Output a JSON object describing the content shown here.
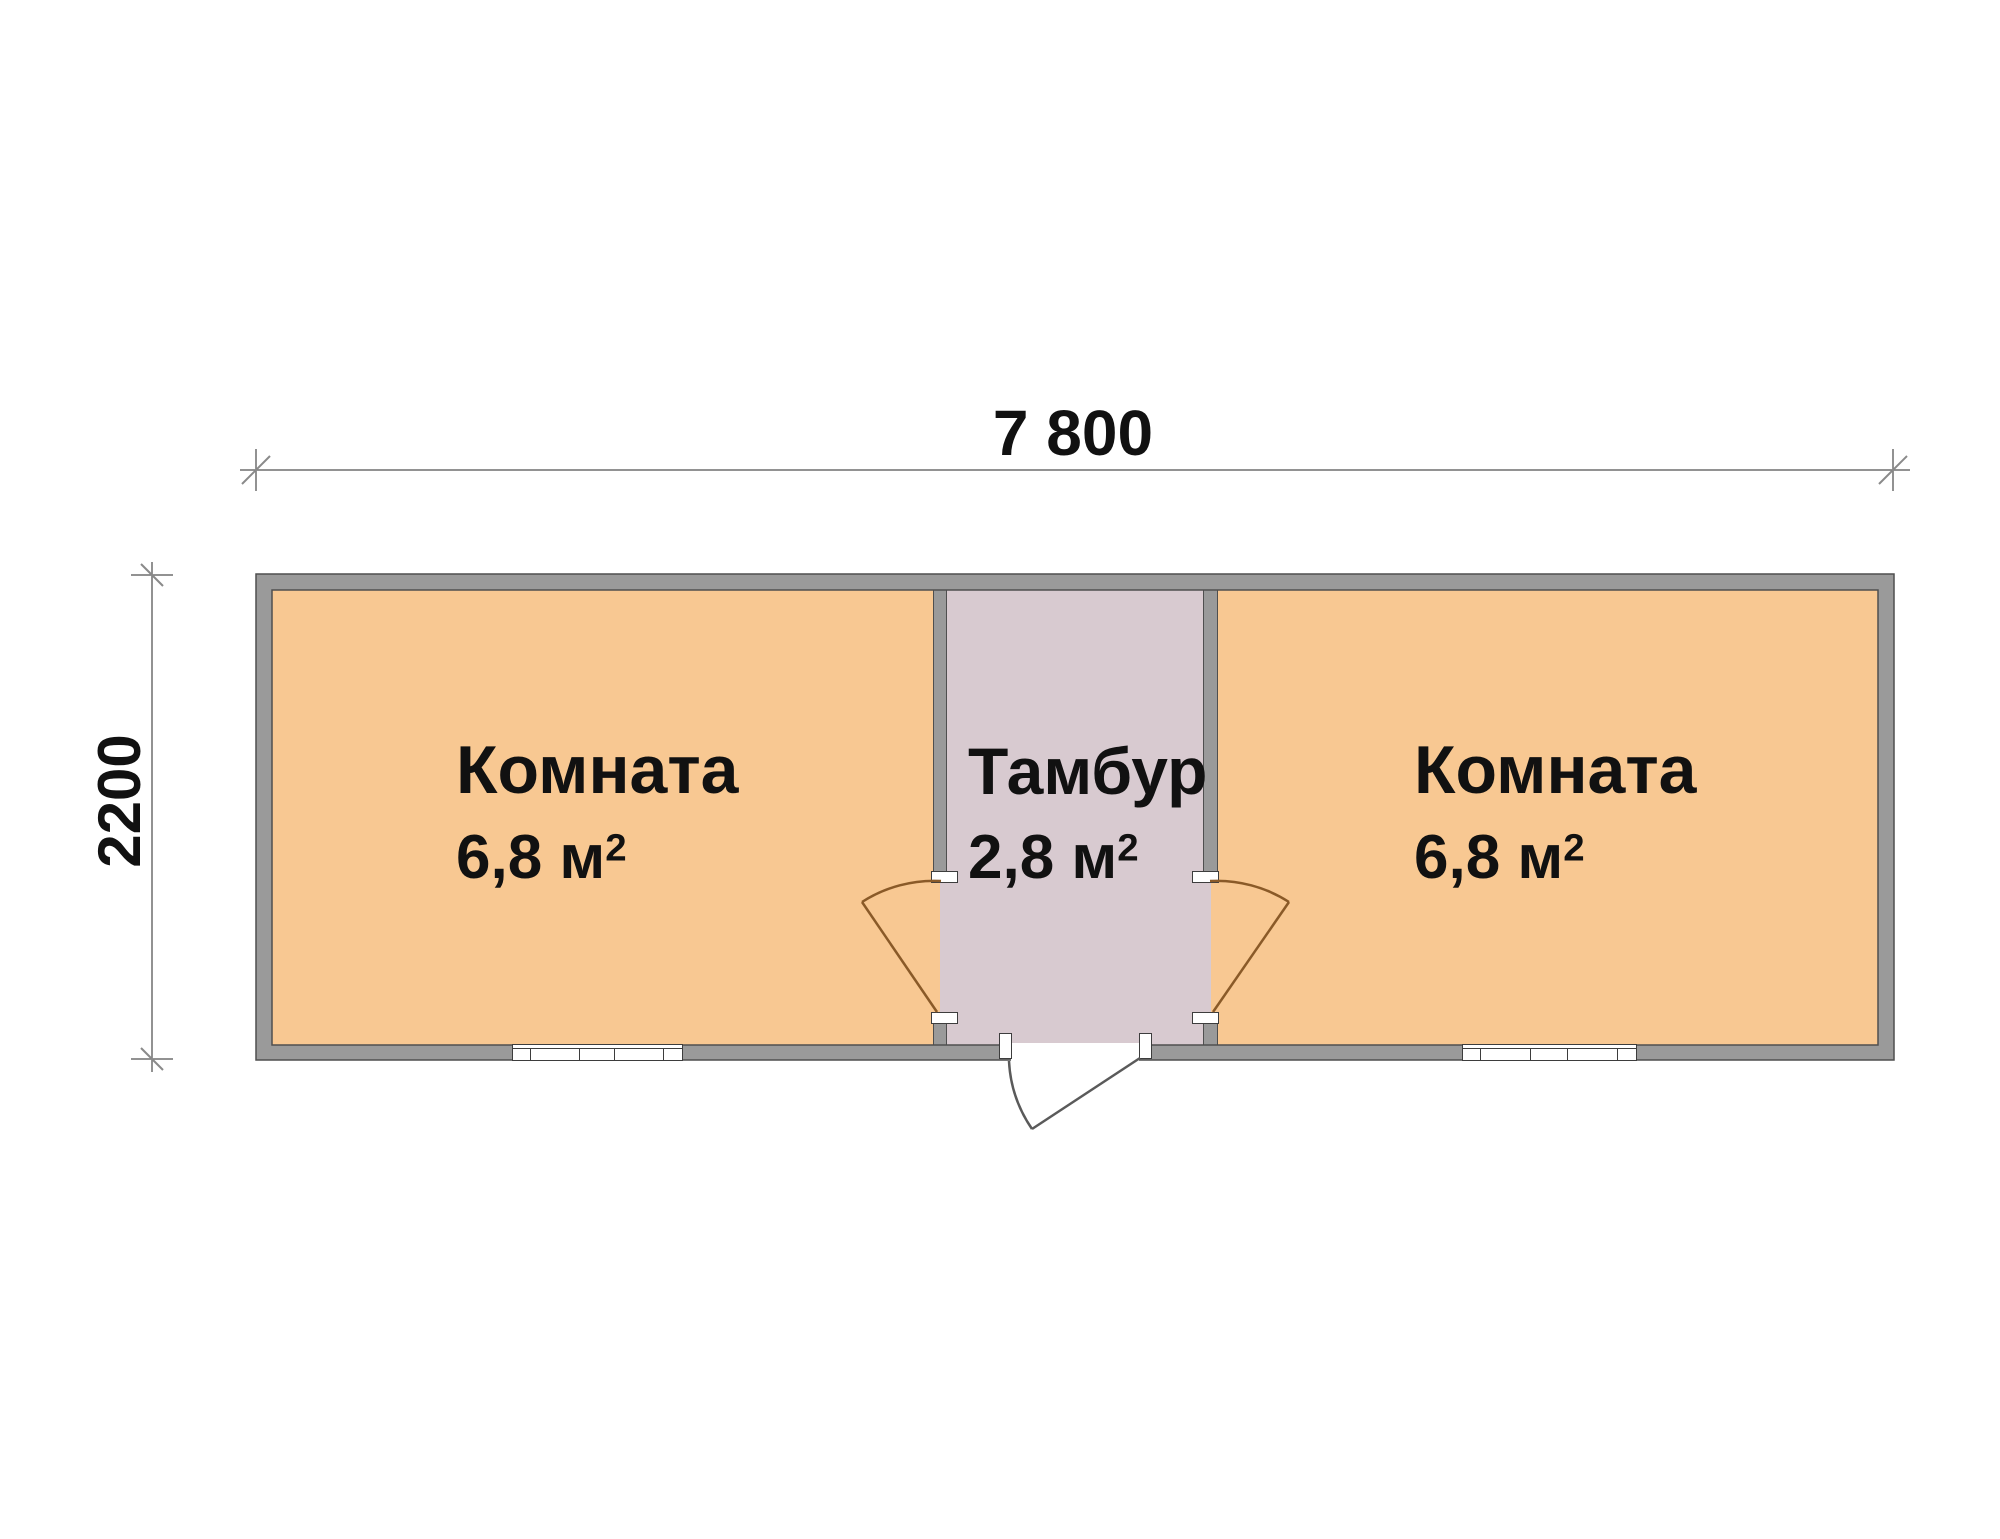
{
  "plan": {
    "type": "floor-plan",
    "dimensions": {
      "width_label": "7 800",
      "height_label": "2200"
    },
    "rooms": [
      {
        "id": "room-left",
        "name": "Комната",
        "area_value": "6,8 м",
        "area_sup": "2"
      },
      {
        "id": "vestibule",
        "name": "Тамбур",
        "area_value": "2,8 м",
        "area_sup": "2"
      },
      {
        "id": "room-right",
        "name": "Комната",
        "area_value": "6,8 м",
        "area_sup": "2"
      }
    ],
    "colors": {
      "room_fill": "#f8c892",
      "vestibule_fill": "#d8cad0",
      "wall": "#9a9a9a",
      "wall_outline": "#4f4f4f",
      "interior_door_line": "#8a5a28",
      "entry_door_line": "#5a5a5a",
      "dimension_line": "#6e6e6e",
      "text": "#111111",
      "background": "#ffffff"
    }
  }
}
